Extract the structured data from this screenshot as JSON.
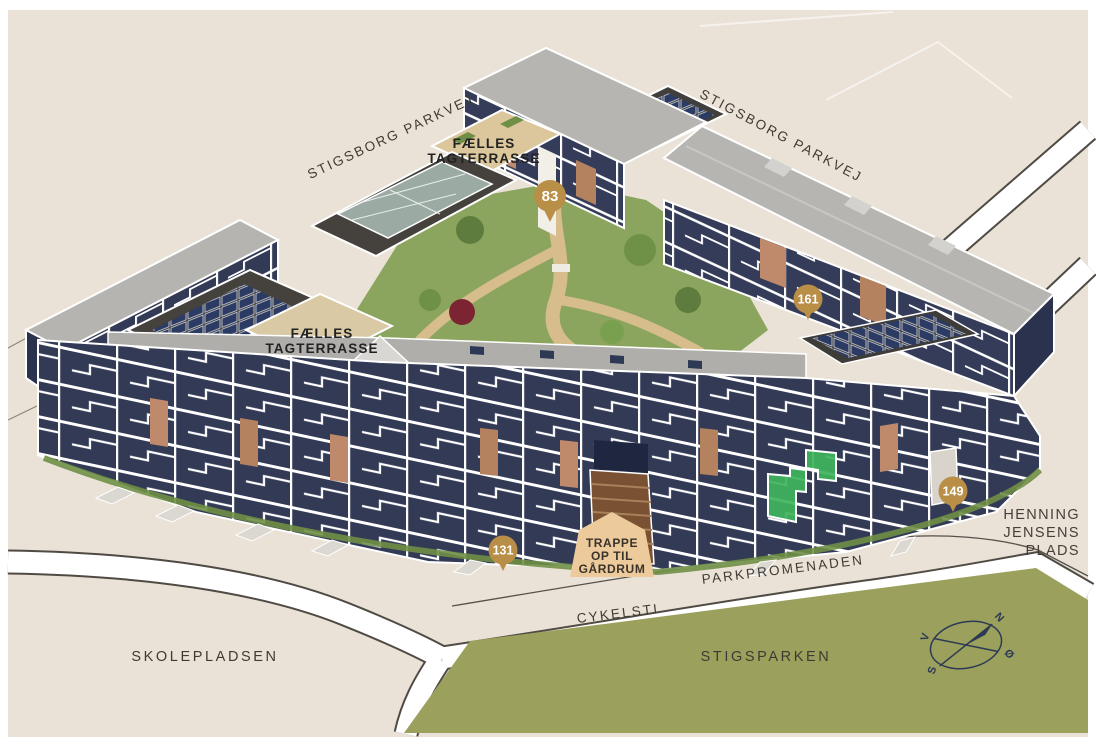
{
  "map": {
    "streets": {
      "stigsborg_left": "STIGSBORG PARKVEJ",
      "stigsborg_right": "STIGSBORG PARKVEJ",
      "parkpromenaden": "PARKPROMENADEN",
      "cykelsti": "CYKELSTI"
    },
    "areas": {
      "skolepladsen": "SKOLEPLADSEN",
      "stigsparken": "STIGSPARKEN",
      "henning_line1": "HENNING",
      "henning_line2": "JENSENS",
      "henning_line3": "PLADS"
    },
    "labels": {
      "terrace_north_line1": "FÆLLES",
      "terrace_north_line2": "TAGTERRASSE",
      "terrace_west_line1": "FÆLLES",
      "terrace_west_line2": "TAGTERRASSE",
      "stairs_line1": "TRAPPE",
      "stairs_line2": "OP TIL",
      "stairs_line3": "GÅRDRUM"
    },
    "badges": [
      {
        "id": "badge-83",
        "value": "83"
      },
      {
        "id": "badge-161",
        "value": "161"
      },
      {
        "id": "badge-149",
        "value": "149"
      },
      {
        "id": "badge-131",
        "value": "131"
      }
    ],
    "compass": {
      "north": "N",
      "south": "S",
      "east": "Ø",
      "west": "V"
    },
    "colors": {
      "background": "#EAE2D7",
      "park": "#9BA05C",
      "facade": "#343B58",
      "roof": "#B6B4B1",
      "flat_roof": "#45423E",
      "badge": "#B98E47",
      "highlight_unit": "#3EB45C",
      "callout": "#ECCA9B",
      "courtyard": "#8CA55E",
      "terrace_wood": "#DCC69C",
      "brick": "#BF8A6C"
    }
  }
}
